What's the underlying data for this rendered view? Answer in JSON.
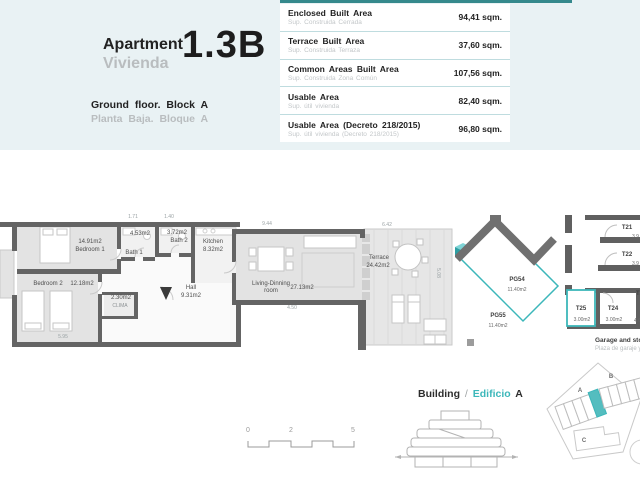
{
  "colors": {
    "accent_teal": "#3cb7ba",
    "header_bg": "#e9f2f4",
    "top_bar_teal": "#35898c",
    "wall_grey": "#646464",
    "room_fill_grey": "#e3e3e3",
    "muted_text_grey": "#b9bdbf"
  },
  "header": {
    "title_en": "Apartment",
    "title_es": "Vivienda",
    "unit": "1.3B",
    "floor_en": "Ground floor. Block A",
    "floor_es": "Planta Baja. Bloque A"
  },
  "areas_table": {
    "rows": [
      {
        "label_en": "Enclosed Built Area",
        "label_es": "Sup. Construida Cerrada",
        "value": "94,41 sqm."
      },
      {
        "label_en": "Terrace Built Area",
        "label_es": "Sup. Construida Terraza",
        "value": "37,60 sqm."
      },
      {
        "label_en": "Common Areas Built Area",
        "label_es": "Sup. Construida Zona Común",
        "value": "107,56 sqm."
      },
      {
        "label_en": "Usable Area",
        "label_es": "Sup. útil vivienda",
        "value": "82,40 sqm."
      },
      {
        "label_en": "Usable Area (Decreto 218/2015)",
        "label_es": "Sup. útil vivienda (Decreto 218/2015)",
        "value": "96,80 sqm."
      }
    ]
  },
  "floorplan": {
    "rooms": [
      {
        "name": "Bedroom 1",
        "area": "14.91m2"
      },
      {
        "name": "Bedroom 2",
        "area": "12.18m2"
      },
      {
        "name": "Bath 1",
        "area": "4.53m2"
      },
      {
        "name": "Bath 2",
        "area": "3.72m2"
      },
      {
        "name": "Kitchen",
        "area": "8.32m2"
      },
      {
        "name": "Hall",
        "area": "9.31m2"
      },
      {
        "name": "CLIMA",
        "area": "2.30m2"
      },
      {
        "name": "Living-Dinning\nroom",
        "area": "27.13m2"
      },
      {
        "name": "Terrace",
        "area": "24.42m2"
      }
    ],
    "dimensions": [
      "1.71",
      "1.40",
      "9.44",
      "6.42",
      "4.50",
      "5.08",
      "5.95"
    ]
  },
  "garage": {
    "caption_en": "Garage and storage room",
    "caption_es": "Plaza de garaje y trastero",
    "parking": [
      {
        "id": "PG54",
        "area": "11.40m2"
      },
      {
        "id": "PG55",
        "area": "11.40m2"
      }
    ],
    "storage": [
      {
        "id": "T21",
        "area": "3.9"
      },
      {
        "id": "T22",
        "area": "3.9"
      },
      {
        "id": "T23",
        "area": "4.6"
      },
      {
        "id": "T24",
        "area": "3.00m2"
      },
      {
        "id": "T25",
        "area": "3.00m2"
      }
    ]
  },
  "scalebar": {
    "labels": [
      "0",
      "2",
      "5"
    ]
  },
  "building": {
    "label_en": "Building",
    "separator": "/",
    "label_es": "Edificio",
    "block": "A"
  },
  "siteplan": {
    "blocks": [
      "A",
      "B",
      "C"
    ]
  }
}
